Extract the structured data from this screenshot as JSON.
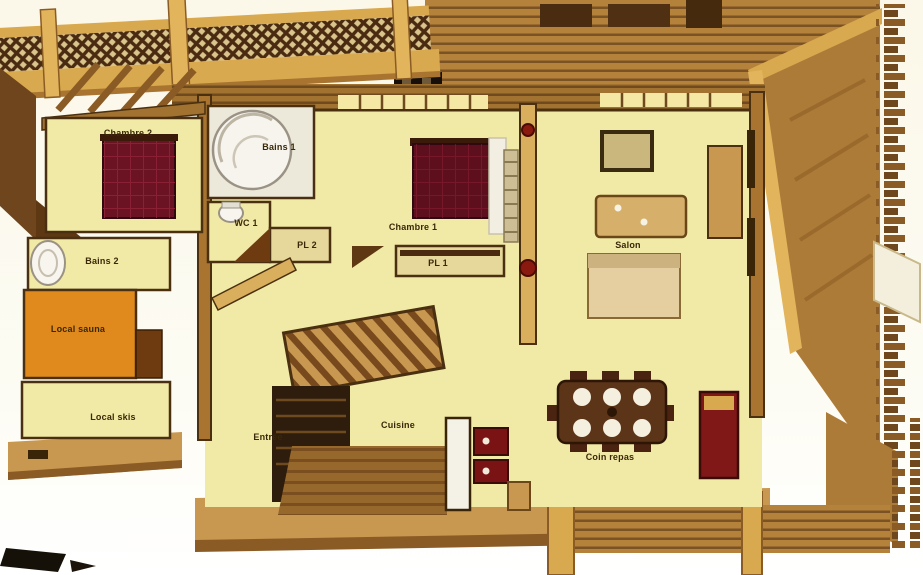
{
  "plan": {
    "type": "chalet-floor-plan-3d-cutaway",
    "rooms": [
      {
        "id": "chambre-2",
        "label": "Chambre 2"
      },
      {
        "id": "bains-1",
        "label": "Bains 1"
      },
      {
        "id": "wc-1",
        "label": "WC 1"
      },
      {
        "id": "pl-2",
        "label": "PL 2"
      },
      {
        "id": "chambre-1",
        "label": "Chambre 1"
      },
      {
        "id": "pl-1",
        "label": "PL 1"
      },
      {
        "id": "salon",
        "label": "Salon"
      },
      {
        "id": "bains-2",
        "label": "Bains 2"
      },
      {
        "id": "local-sauna",
        "label": "Local sauna"
      },
      {
        "id": "local-skis",
        "label": "Local skis"
      },
      {
        "id": "entree",
        "label": "Entrée"
      },
      {
        "id": "cuisine",
        "label": "Cuisine"
      },
      {
        "id": "coin-repas",
        "label": "Coin repas"
      }
    ],
    "colors": {
      "background": "#fdfbf2",
      "floor": "#f1e9a6",
      "wall_wood": "#d9ae5c",
      "wall_outline": "#4a3010",
      "log_wood": "#a87430",
      "log_stripe": "#6e4a1e",
      "roof": "#ad7b38",
      "sauna_orange": "#e08a1e",
      "bed_maroon": "#6b1322",
      "appliance_red": "#7a1414",
      "dining_table": "#5c3418",
      "label_text": "#3a2808"
    }
  }
}
